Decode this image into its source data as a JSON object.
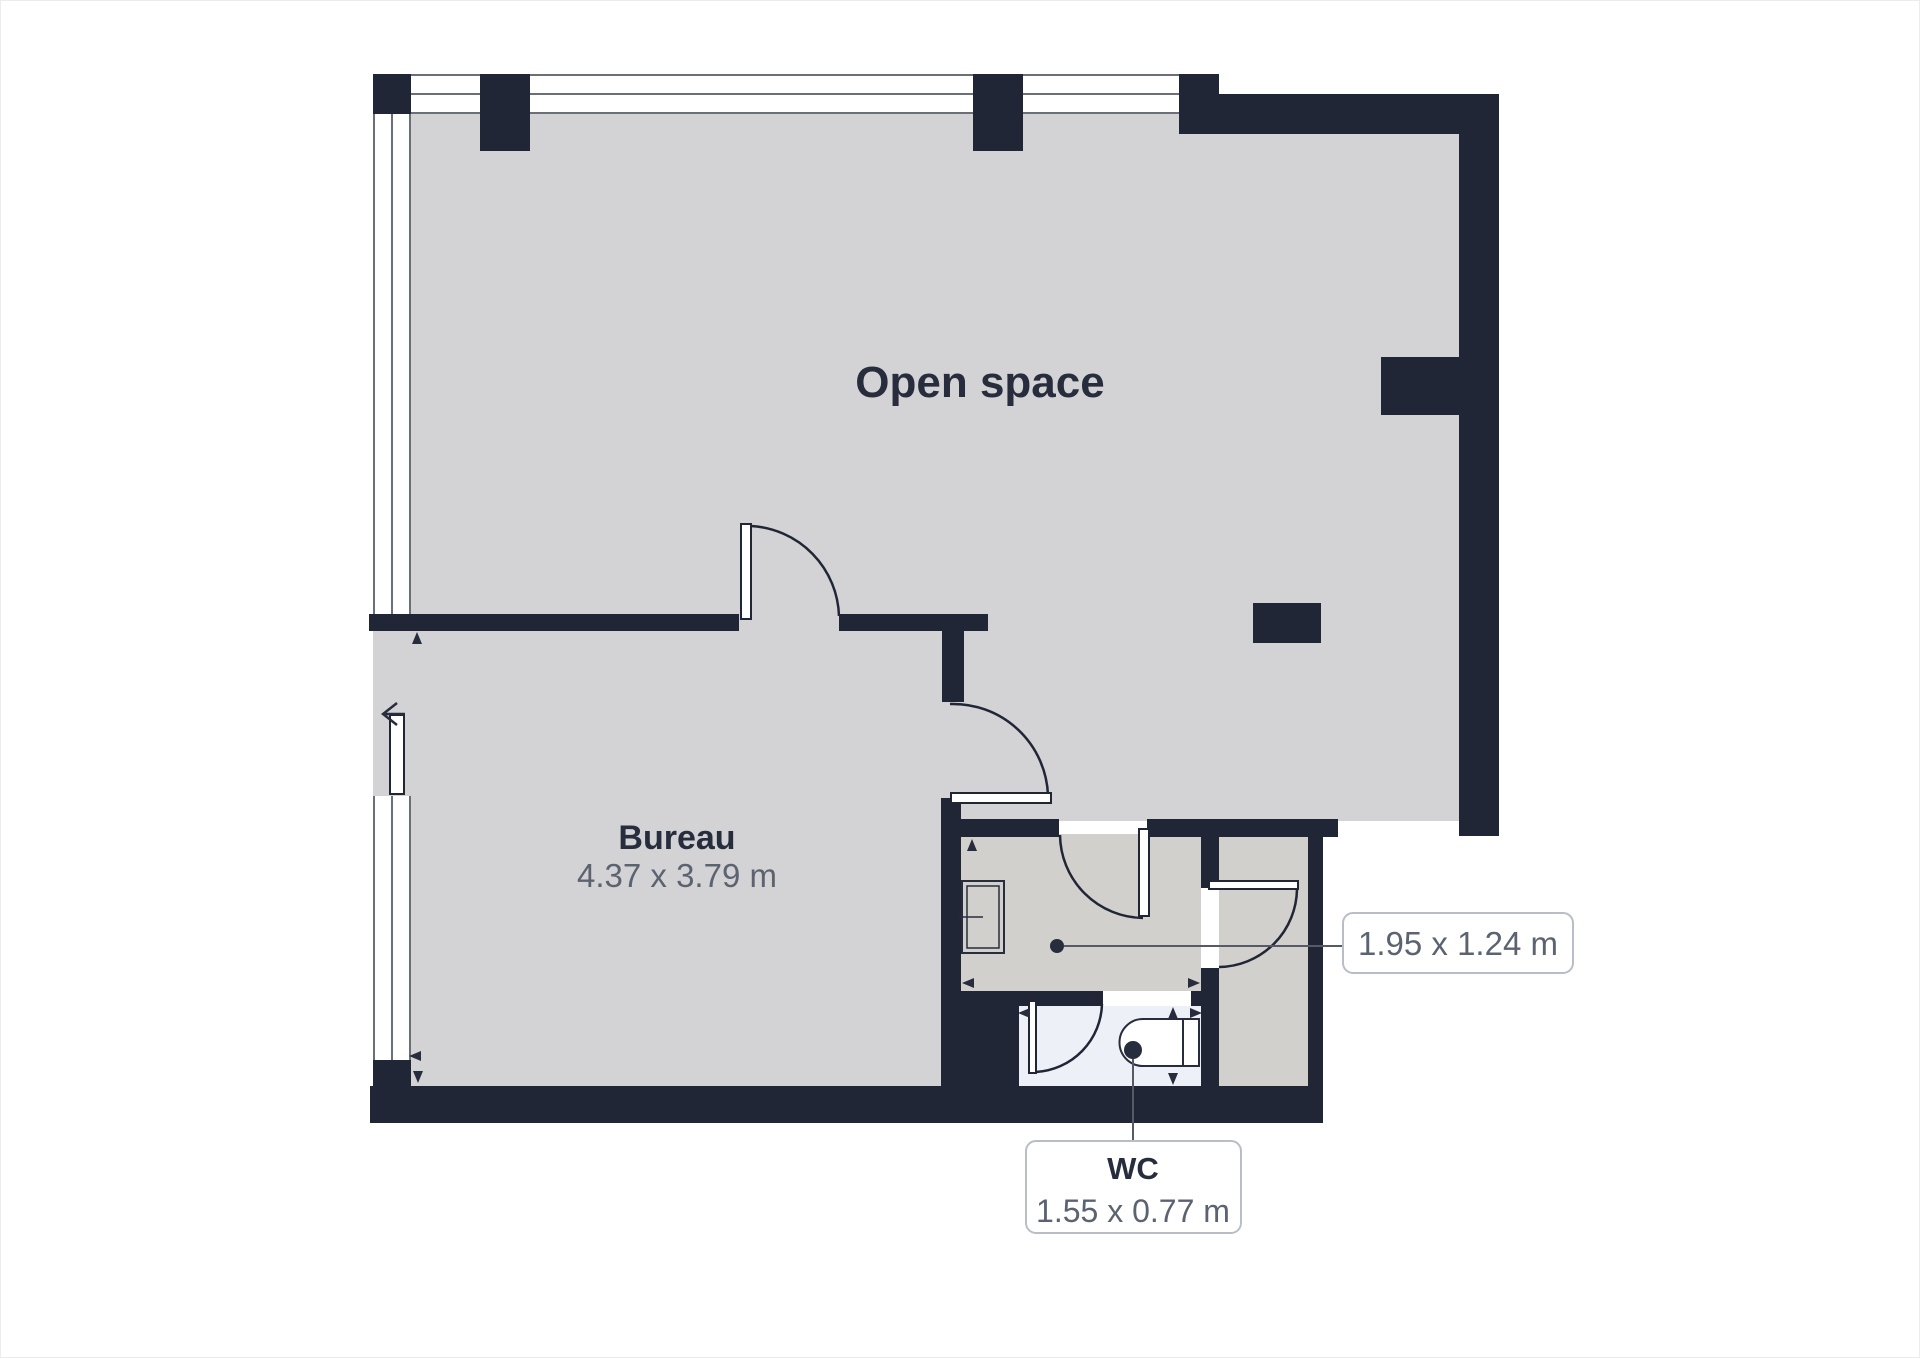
{
  "rooms": {
    "open_space": {
      "label": "Open space"
    },
    "bureau": {
      "label": "Bureau",
      "dimensions": "4.37 x 3.79 m"
    },
    "hallway": {
      "dimensions": "1.95 x 1.24 m"
    },
    "wc": {
      "label": "WC",
      "dimensions": "1.55 x 0.77 m"
    }
  },
  "colors": {
    "wall": "#202636",
    "floor_main": "#d3d3d5",
    "floor_secondary": "#d2d0cc",
    "floor_wc": "#edf1f7",
    "text_dark": "#272d3d",
    "text_gray": "#5c6370",
    "callout_border": "#b9bec6",
    "window_line": "#6b7078",
    "leader_line": "#555a66"
  }
}
